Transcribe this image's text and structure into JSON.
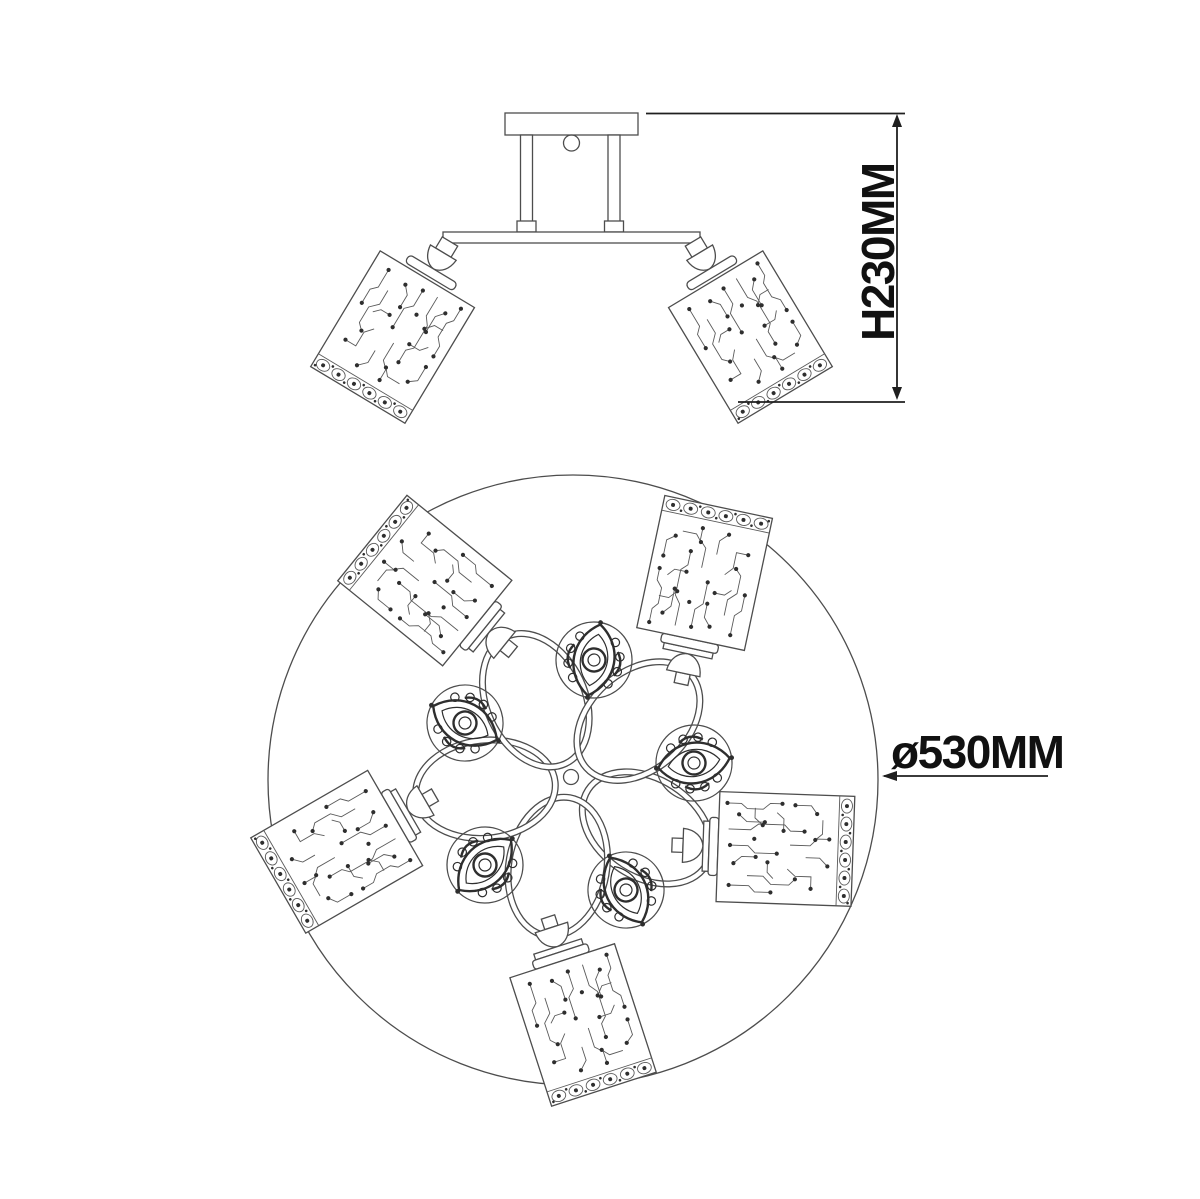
{
  "drawing": {
    "type": "ceiling-chandelier-technical-drawing",
    "views": 2,
    "dimensions": {
      "height_label": "H230MM",
      "diameter_label": "ø530MM"
    },
    "colors": {
      "line": "#4d4d4d",
      "detail": "#2e2e2e",
      "dimension": "#1f1f1f",
      "background": "#ffffff"
    }
  }
}
